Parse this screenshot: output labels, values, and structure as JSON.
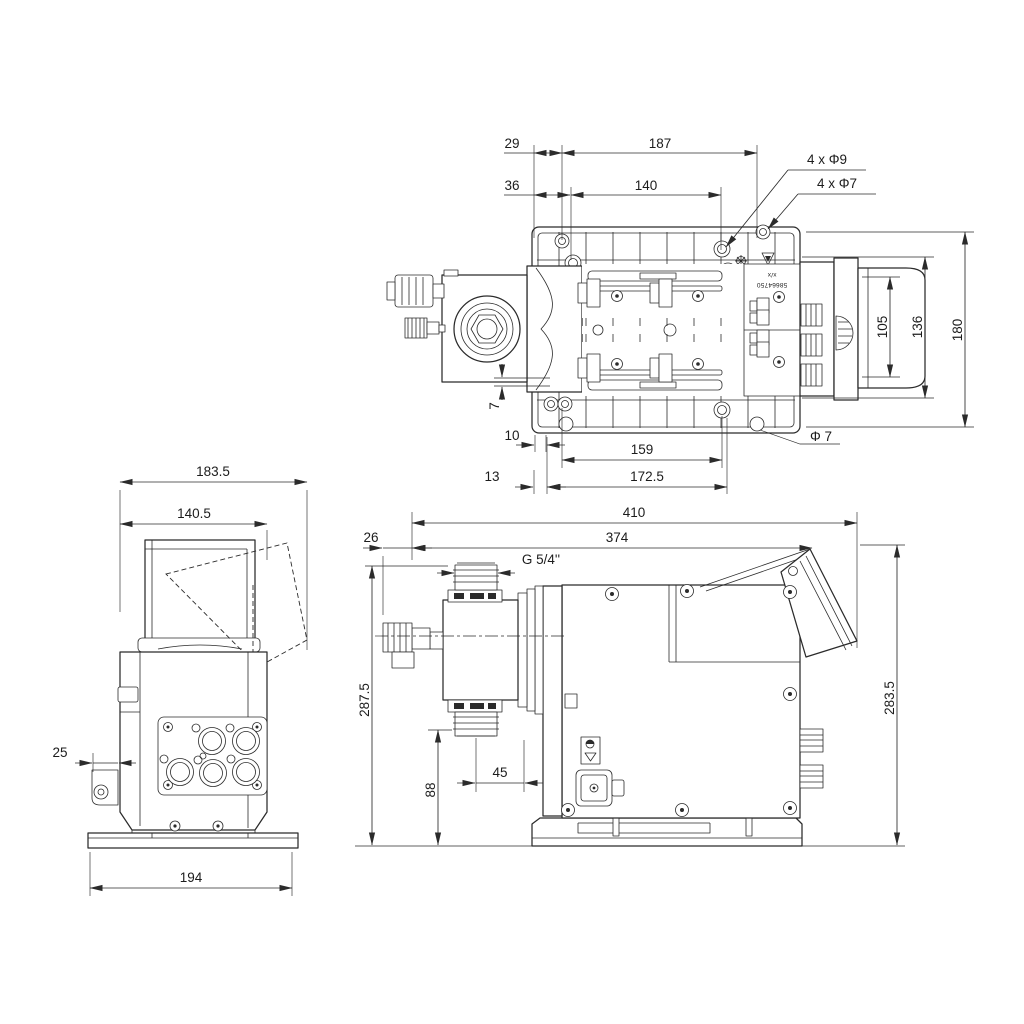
{
  "document": {
    "kind": "technical dimensional drawing",
    "subject": "dosing pump, three orthographic views",
    "background_color": "#ffffff",
    "line_color": "#2b2b2b",
    "text_color": "#1c1c1c"
  },
  "dims": {
    "top": {
      "d29": "29",
      "d187": "187",
      "d36": "36",
      "d140": "140",
      "holes_d9": "4 x Φ9",
      "holes_d7": "4 x Φ7",
      "d105": "105",
      "d136": "136",
      "d180": "180",
      "d7": "7",
      "d10": "10",
      "d159": "159",
      "dia7": "Φ 7",
      "d13": "13",
      "d172_5": "172.5"
    },
    "side": {
      "d183_5": "183.5",
      "d140_5": "140.5",
      "d25": "25",
      "d194": "194"
    },
    "front": {
      "d410": "410",
      "d26": "26",
      "d374": "374",
      "thread": "G 5/4''",
      "d287_5": "287.5",
      "d88": "88",
      "d45": "45",
      "d283_5": "283.5"
    }
  },
  "labels": {
    "type_plate_top": "x/x",
    "type_plate_number": "58664750"
  }
}
